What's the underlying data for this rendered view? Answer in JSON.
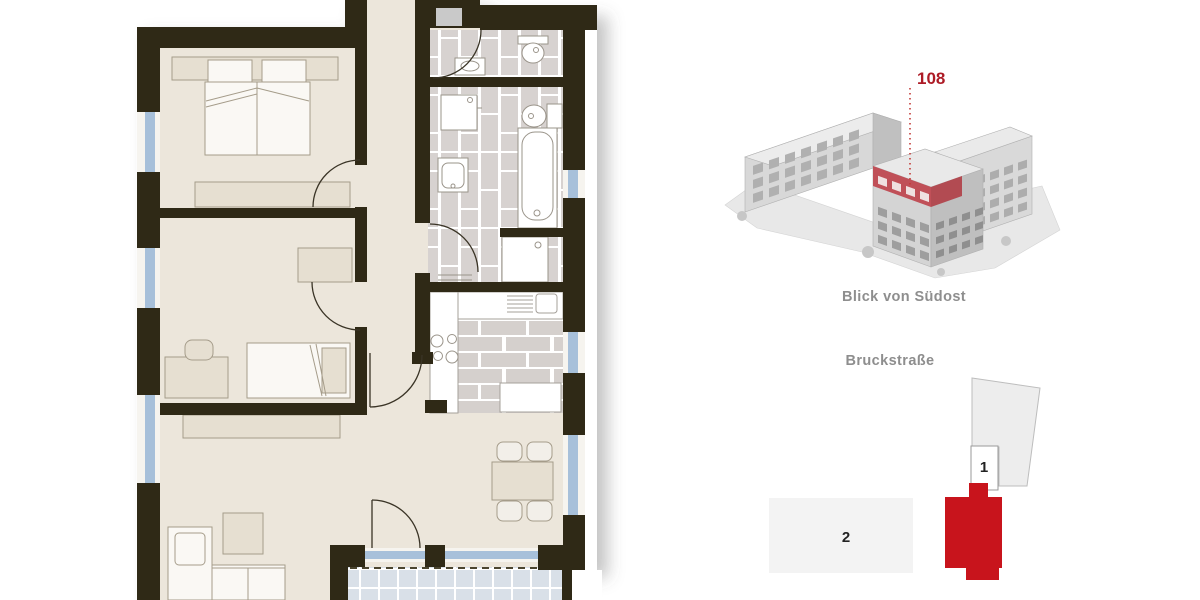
{
  "building_view": {
    "unit_label": "108",
    "caption": "Blick von Südost",
    "accent_color": "#ad1b26",
    "highlight_band_color": "#c05058"
  },
  "site_plan": {
    "street_label": "Bruckstraße",
    "building_1_label": "1",
    "building_2_label": "2",
    "highlight_color": "#c8141c",
    "plot_color": "#ededed"
  },
  "floorplan": {
    "wall_color": "#2f2916",
    "floor_color": "#ece6db",
    "tile_color": "#d7d2d0",
    "window_color": "#a7c0da",
    "balcony_tile_color": "#d9e0e8",
    "furniture_beige": "#e6dfd1",
    "furniture_white": "#faf8f4"
  }
}
